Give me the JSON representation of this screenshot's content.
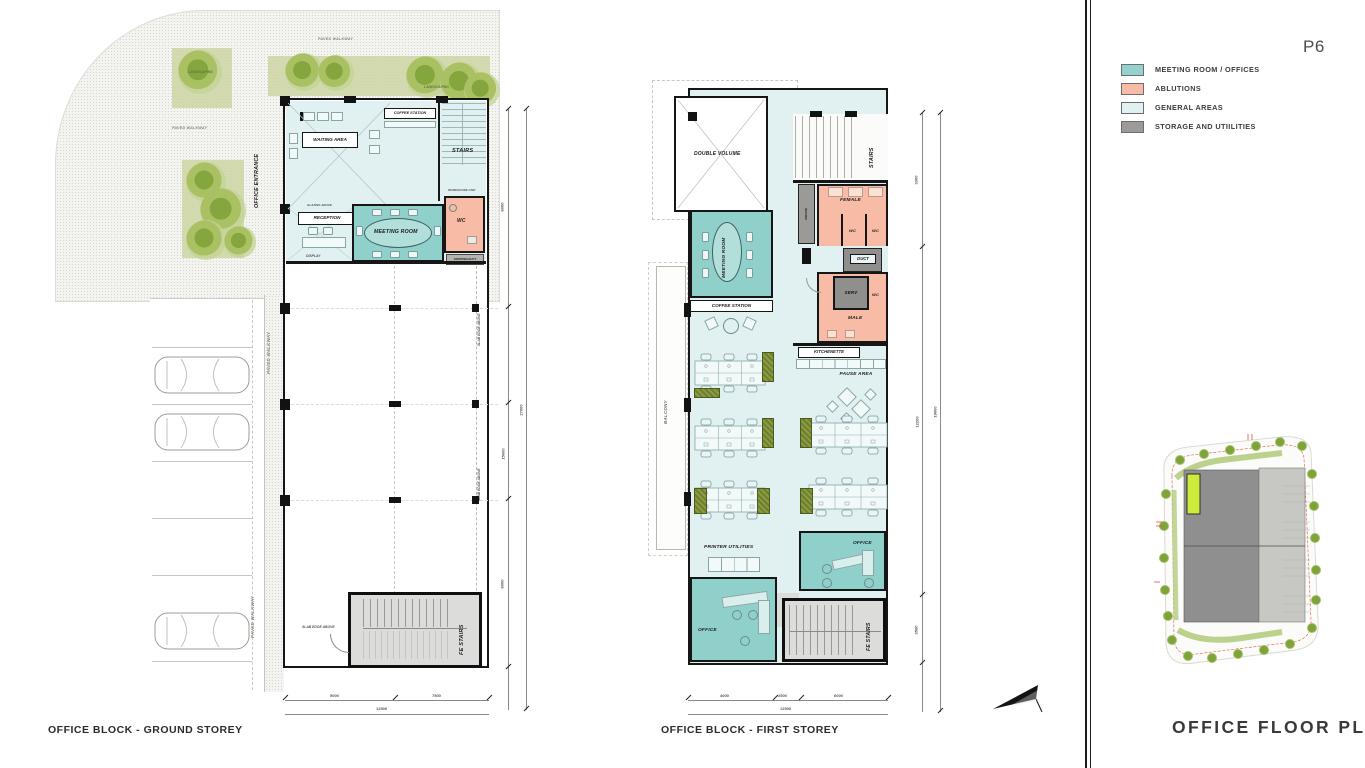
{
  "page": {
    "number": "P6",
    "title": "OFFICE FLOOR PLANS"
  },
  "legend": {
    "items": [
      {
        "label": "MEETING ROOM / OFFICES",
        "color": "#96d2cd"
      },
      {
        "label": "ABLUTIONS",
        "color": "#f8bca6"
      },
      {
        "label": "GENERAL AREAS",
        "color": "#e1f0f1"
      },
      {
        "label": "STORAGE AND UTIILITIES",
        "color": "#9b9b99"
      }
    ]
  },
  "colors": {
    "walls": "#161616",
    "landscaping": "#cdd5a5",
    "tree": "#9ab95c",
    "site_highlight": "#cdeb3c",
    "storage_light": "#dcdcda",
    "storage_dark": "#8f8f8d"
  },
  "ground": {
    "caption": "OFFICE BLOCK - GROUND STOREY",
    "site": {
      "paved_walkway_top": "PAVED WALKWAY",
      "paved_walkway_left": "PAVED WALKWAY",
      "paved_walkway_strip_upper": "PAVED WALKWAY",
      "paved_walkway_strip_lower": "PAVED WALKWAY",
      "landscaping_left": "LANDSCAPING",
      "landscaping_right": "LANDSCAPING",
      "office_entrance": "OFFICE ENTRANCE"
    },
    "rooms": {
      "waiting_area": "WAITING AREA",
      "coffee_station": "COFFEE STATION",
      "stairs": "STAIRS",
      "reception": "RECEPTION",
      "meeting_room": "MEETING ROOM",
      "wc": "WC",
      "dropped_duct": "DROPPED DUCT",
      "fe_stairs": "FE STAIRS"
    },
    "notes": {
      "warehouse_link": "WAREHOUSE LINK",
      "display": "DISPLAY",
      "glazing_above": "GLAZING ABOVE",
      "slab_edge_upper": "SLAB EDGE ABOVE",
      "slab_edge_lower": "SLAB EDGE ABOVE",
      "slab_edge_fe": "SLAB EDGE ABOVE"
    },
    "dims": {
      "b1": "5000",
      "b2": "7500",
      "b_total": "12500",
      "r1": "6000",
      "r2": "15000",
      "r3": "6000",
      "r_total": "27000"
    }
  },
  "first": {
    "caption": "OFFICE BLOCK - FIRST STOREY",
    "rooms": {
      "double_volume": "DOUBLE VOLUME",
      "stairs": "STAIRS",
      "private": "PRIVATE",
      "female": "FEMALE",
      "wc_f1": "WC",
      "wc_f2": "WC",
      "duct": "DUCT",
      "serv": "SERV",
      "wc_m": "WC",
      "male": "MALE",
      "meeting_room": "MEETING ROOM",
      "coffee_station": "COFFEE STATION",
      "kitchenette": "KITCHENETTE",
      "pause_area": "PAUSE AREA",
      "balcony": "BALCONY",
      "printer_utilities": "PRINTER UTILITIES",
      "office_right": "OFFICE",
      "office_left": "OFFICE",
      "fe_stairs": "FE STAIRS"
    },
    "dims": {
      "b1": "4000",
      "b2": "2500",
      "b3": "6000",
      "b_total": "12500",
      "r1": "3300",
      "r2": "12200",
      "r3": "3500",
      "r_total": "19000"
    }
  }
}
